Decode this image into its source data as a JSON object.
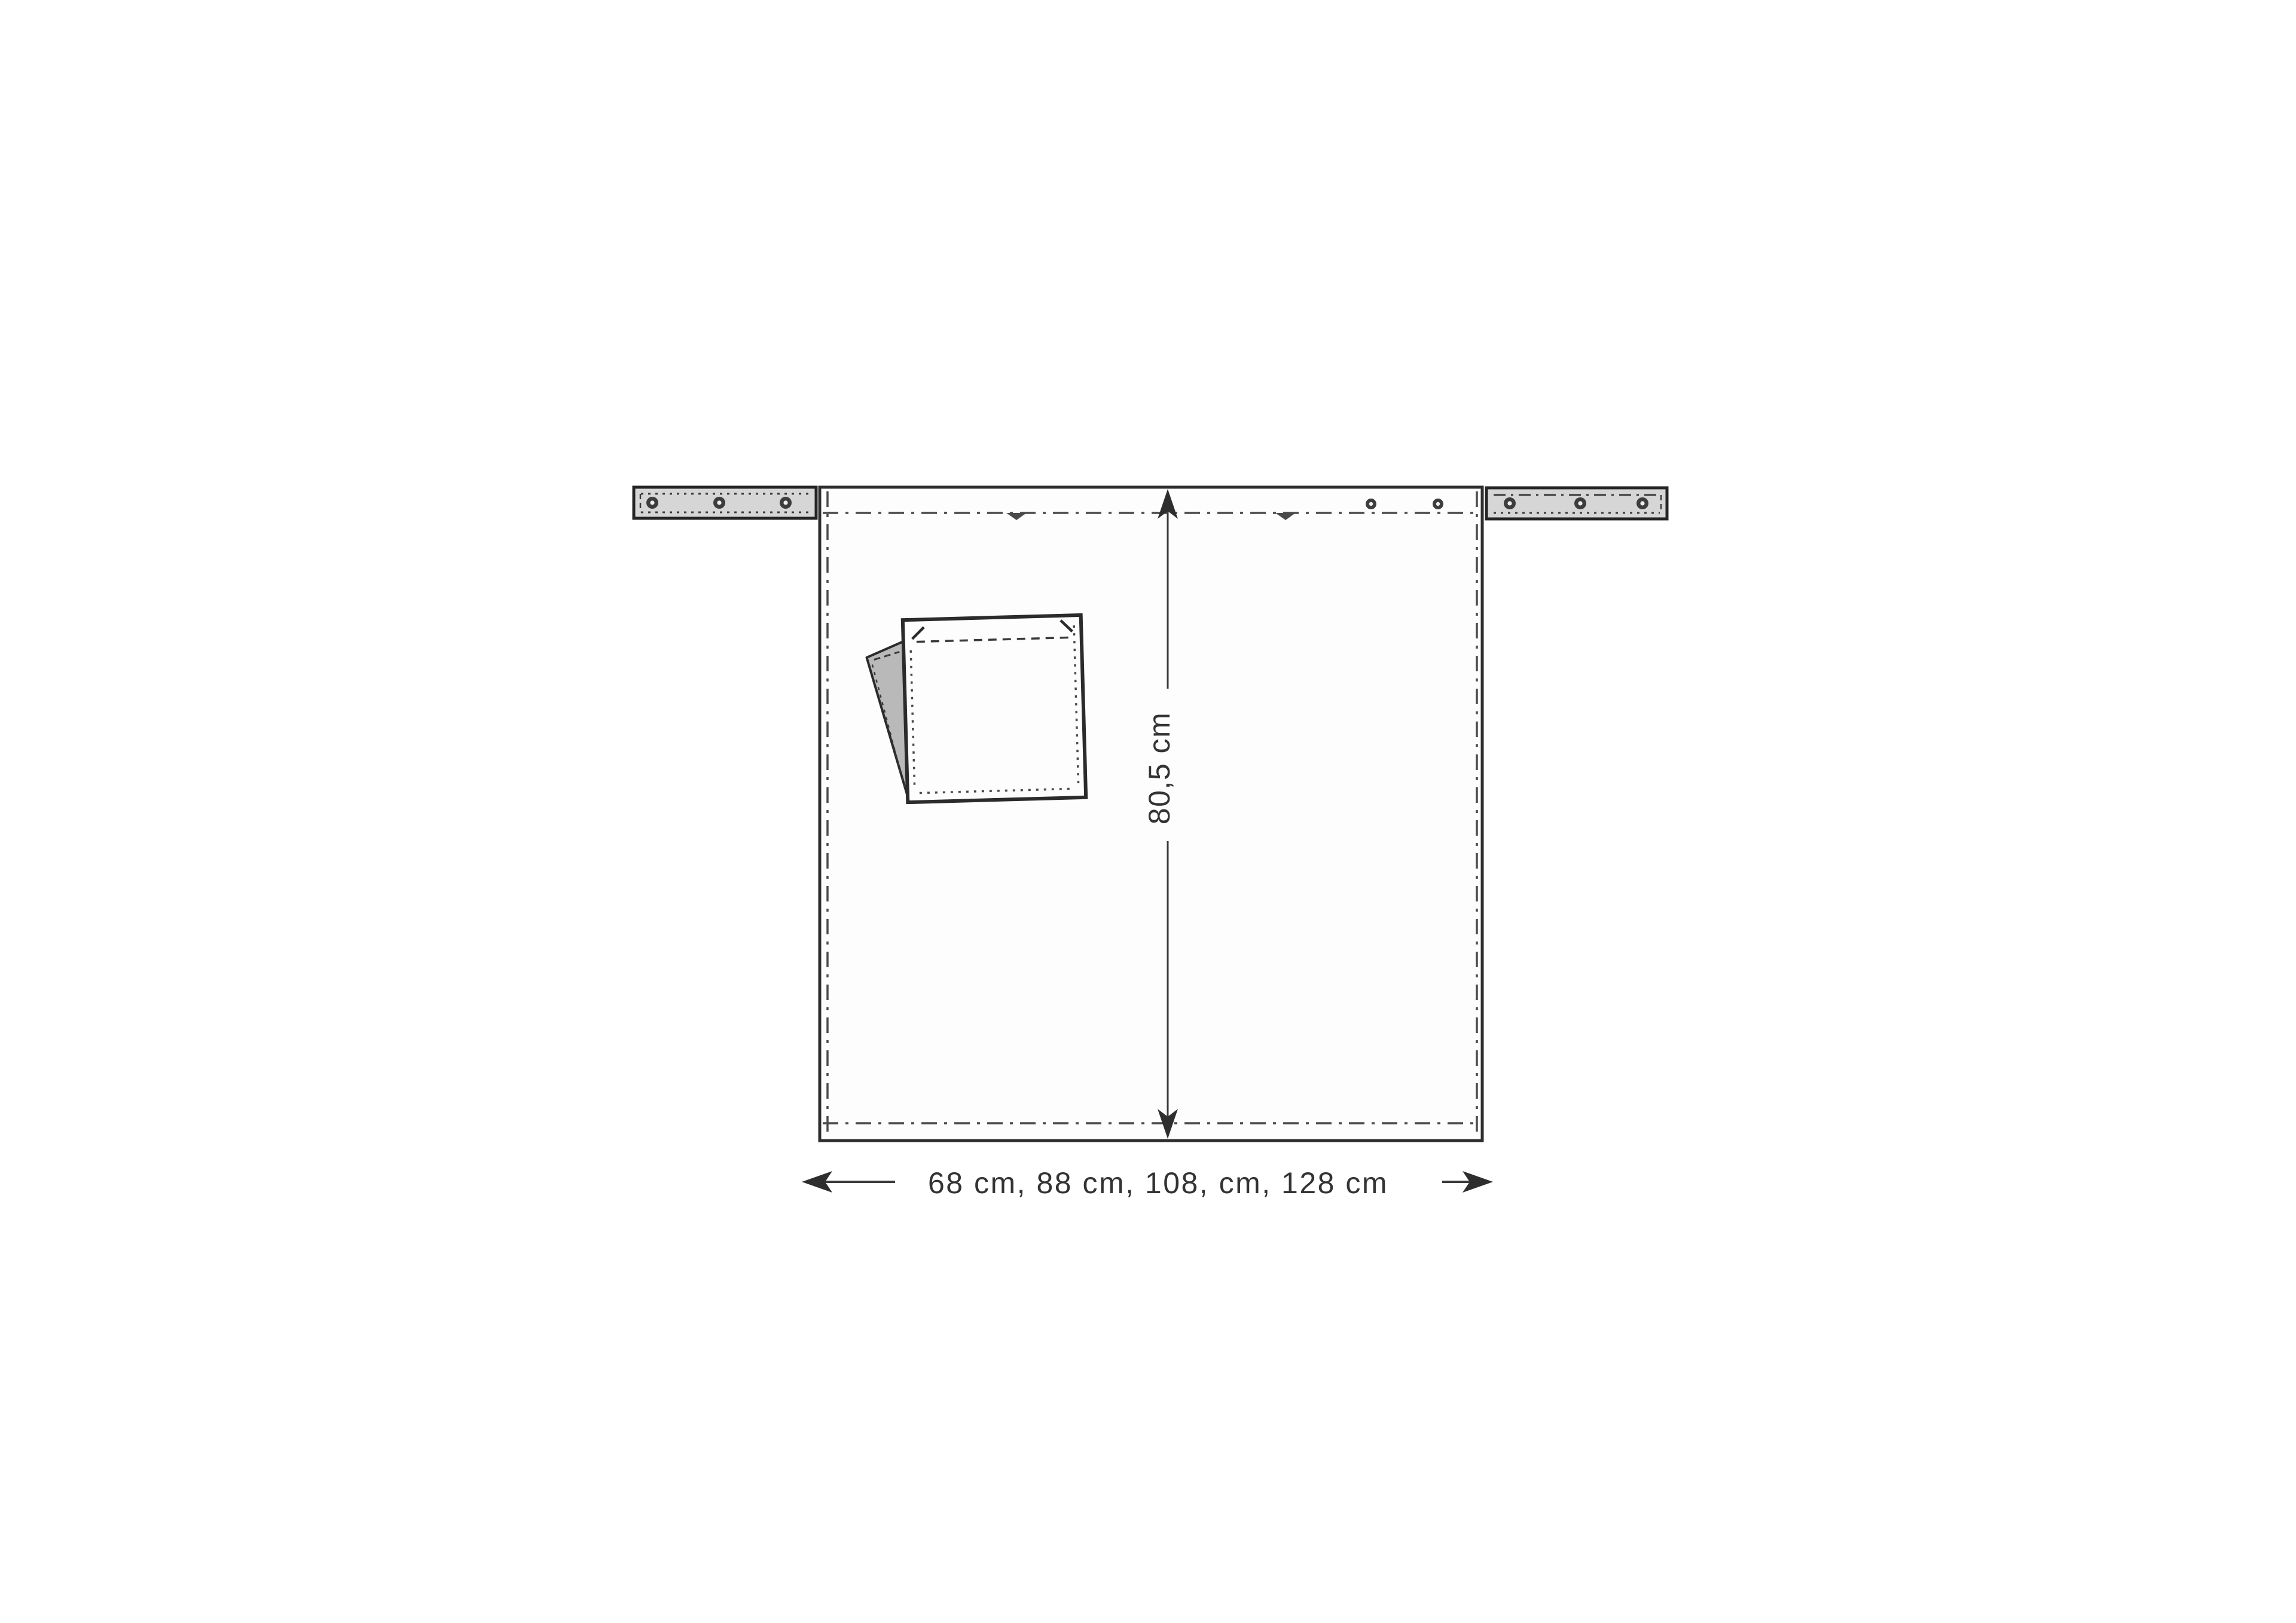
{
  "figure": {
    "kind": "apron-pattern-schematic",
    "height_dimension": {
      "label": "80,5 cm"
    },
    "width_dimension": {
      "label": "68 cm, 88 cm, 108, cm, 128 cm"
    }
  },
  "colors": {
    "background": "#ffffff",
    "fabric": "#fdfdfd",
    "outline": "#2e2e2e",
    "stitch": "#4a4a4a",
    "tie_fill": "#d6d6d6",
    "fold_flap_fill": "#b9b9b9",
    "grommet_ring": "#3d3d3d",
    "grommet_hole": "#efefef",
    "text": "#333333"
  }
}
